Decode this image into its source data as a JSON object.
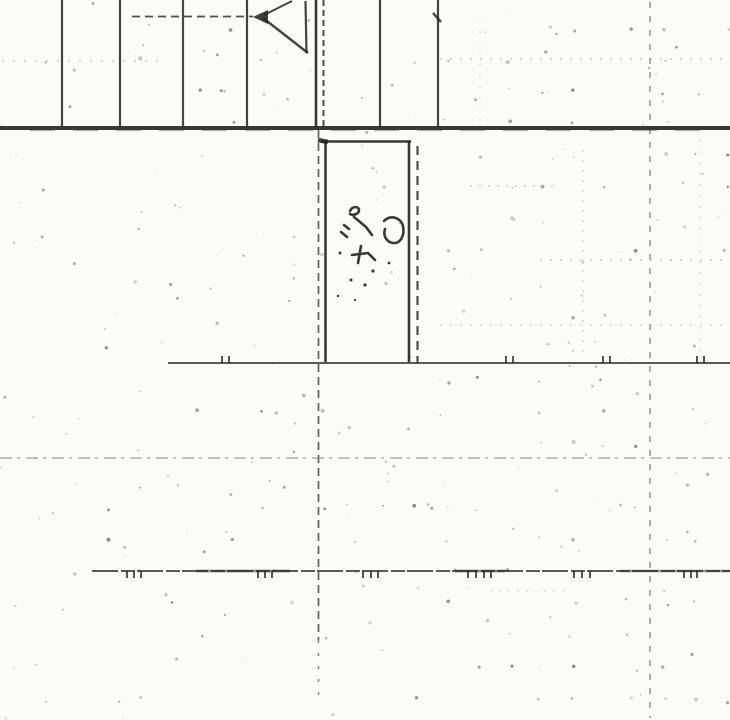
{
  "document": {
    "kind_label": "scanned architectural plan detail",
    "annotation": {
      "text": "30"
    }
  },
  "colors": {
    "paper": "#fbfbf8",
    "ink": "#26241f",
    "ink_light": "#8a887f",
    "noise": "#4a483f"
  },
  "drawing": {
    "width": 730,
    "height": 720,
    "lines": [
      {
        "name": "grid-vertical-1",
        "x1": 62,
        "y1": 0,
        "x2": 62,
        "y2": 126,
        "w": 2.2,
        "o": 0.85
      },
      {
        "name": "grid-vertical-2",
        "x1": 120,
        "y1": 0,
        "x2": 120,
        "y2": 126,
        "w": 2.2,
        "o": 0.85
      },
      {
        "name": "grid-vertical-3",
        "x1": 183,
        "y1": 0,
        "x2": 183,
        "y2": 126,
        "w": 2.2,
        "o": 0.82
      },
      {
        "name": "grid-vertical-4",
        "x1": 247,
        "y1": 0,
        "x2": 247,
        "y2": 126,
        "w": 2.2,
        "o": 0.85
      },
      {
        "name": "wall-jamb-solid",
        "x1": 316,
        "y1": 0,
        "x2": 316,
        "y2": 127,
        "w": 2.6,
        "o": 0.9
      },
      {
        "name": "wall-jamb-dashed",
        "x1": 323.5,
        "y1": 0,
        "x2": 323.5,
        "y2": 127,
        "w": 2.0,
        "o": 0.8,
        "dash": "6 4"
      },
      {
        "name": "grid-vertical-5",
        "x1": 380,
        "y1": 0,
        "x2": 380,
        "y2": 127,
        "w": 2.2,
        "o": 0.85
      },
      {
        "name": "grid-vertical-6",
        "x1": 438,
        "y1": 0,
        "x2": 438,
        "y2": 127,
        "w": 2.2,
        "o": 0.85
      },
      {
        "name": "grid-v6-top-tick",
        "x1": 433,
        "y1": 13,
        "x2": 441,
        "y2": 22,
        "w": 2.6,
        "o": 0.8
      },
      {
        "name": "floor-line-main",
        "x1": 0,
        "y1": 128,
        "x2": 730,
        "y2": 128,
        "w": 4.0,
        "o": 0.9
      },
      {
        "name": "floor-line-texture",
        "x1": 30,
        "y1": 130.5,
        "x2": 710,
        "y2": 130.5,
        "w": 1.2,
        "o": 0.35,
        "dash": "25 18"
      },
      {
        "name": "arrow-leader-dashed",
        "x1": 132,
        "y1": 16.5,
        "x2": 253,
        "y2": 16.5,
        "w": 1.8,
        "o": 0.8,
        "dash": "8 5"
      },
      {
        "name": "arrow-upper-diagonal",
        "x1": 264,
        "y1": 15,
        "x2": 292,
        "y2": 1,
        "w": 2.0,
        "o": 0.85
      },
      {
        "name": "arrow-lower-diagonal",
        "x1": 263,
        "y1": 18,
        "x2": 308,
        "y2": 53,
        "w": 2.4,
        "o": 0.85
      },
      {
        "name": "arrow-right-vertical",
        "x1": 305.5,
        "y1": 1,
        "x2": 306.5,
        "y2": 53,
        "w": 2.2,
        "o": 0.85
      },
      {
        "name": "door-left-edge",
        "x1": 325.5,
        "y1": 140,
        "x2": 325.5,
        "y2": 362,
        "w": 2.6,
        "o": 0.9
      },
      {
        "name": "door-top-edge",
        "x1": 321,
        "y1": 141.5,
        "x2": 411,
        "y2": 141.5,
        "w": 2.6,
        "o": 0.9
      },
      {
        "name": "door-corner-blob",
        "x1": 318,
        "y1": 140,
        "x2": 328,
        "y2": 142,
        "w": 4.5,
        "o": 0.85
      },
      {
        "name": "door-right-edge",
        "x1": 409,
        "y1": 141,
        "x2": 409,
        "y2": 362,
        "w": 2.6,
        "o": 0.9
      },
      {
        "name": "door-right-dashed",
        "x1": 417.5,
        "y1": 146,
        "x2": 417.5,
        "y2": 363,
        "w": 2.2,
        "o": 0.8,
        "dash": "9 6"
      },
      {
        "name": "center-axis-dashed",
        "x1": 318.5,
        "y1": 130,
        "x2": 318.5,
        "y2": 640,
        "w": 1.7,
        "o": 0.72,
        "dash": "8 5"
      },
      {
        "name": "center-axis-dotted-tail",
        "x1": 318.5,
        "y1": 640,
        "x2": 318.5,
        "y2": 698,
        "w": 1.5,
        "o": 0.55,
        "dash": "3 10"
      },
      {
        "name": "right-axis-dashed",
        "x1": 650,
        "y1": 2,
        "x2": 650,
        "y2": 718,
        "w": 1.4,
        "o": 0.5,
        "dash": "6 8"
      },
      {
        "name": "level-line-upper",
        "x1": 168,
        "y1": 363,
        "x2": 730,
        "y2": 363,
        "w": 1.7,
        "o": 0.85
      },
      {
        "name": "level-line-middle-faint",
        "x1": 0,
        "y1": 458,
        "x2": 730,
        "y2": 458,
        "w": 1.3,
        "o": 0.8,
        "dash": "12 5 3 6",
        "light": true
      },
      {
        "name": "level-line-lower",
        "x1": 92,
        "y1": 571,
        "x2": 730,
        "y2": 571,
        "w": 1.7,
        "o": 0.85,
        "dash": "26 3 14 2"
      },
      {
        "name": "lower-line-thick-1",
        "x1": 196,
        "y1": 571,
        "x2": 290,
        "y2": 571,
        "w": 2.8,
        "o": 0.5
      },
      {
        "name": "lower-line-thick-2",
        "x1": 455,
        "y1": 571,
        "x2": 505,
        "y2": 571,
        "w": 2.8,
        "o": 0.5
      },
      {
        "name": "lower-line-thick-3",
        "x1": 620,
        "y1": 571,
        "x2": 730,
        "y2": 571,
        "w": 2.4,
        "o": 0.45
      },
      {
        "name": "texture-row-top-left",
        "x1": 2,
        "y1": 61,
        "x2": 160,
        "y2": 61,
        "w": 1.2,
        "o": 0.5,
        "dash": "2 9",
        "light": true
      },
      {
        "name": "texture-row-top-right",
        "x1": 440,
        "y1": 59,
        "x2": 728,
        "y2": 59,
        "w": 1.2,
        "o": 0.5,
        "dash": "2 8",
        "light": true
      },
      {
        "name": "texture-row-mid-1",
        "x1": 470,
        "y1": 186,
        "x2": 560,
        "y2": 186,
        "w": 1.2,
        "o": 0.45,
        "dash": "2 7",
        "light": true
      },
      {
        "name": "texture-row-mid-2",
        "x1": 540,
        "y1": 260,
        "x2": 730,
        "y2": 260,
        "w": 1.2,
        "o": 0.45,
        "dash": "2 8",
        "light": true
      },
      {
        "name": "texture-row-mid-3",
        "x1": 440,
        "y1": 325,
        "x2": 730,
        "y2": 325,
        "w": 1.2,
        "o": 0.4,
        "dash": "2 8",
        "light": true
      },
      {
        "name": "texture-row-low",
        "x1": 490,
        "y1": 591,
        "x2": 565,
        "y2": 591,
        "w": 1.1,
        "o": 0.4,
        "dash": "2 7",
        "light": true
      },
      {
        "name": "texture-col-1",
        "x1": 583,
        "y1": 150,
        "x2": 583,
        "y2": 360,
        "w": 1.2,
        "o": 0.4,
        "dash": "2 8",
        "light": true
      },
      {
        "name": "texture-col-2",
        "x1": 700,
        "y1": 140,
        "x2": 700,
        "y2": 360,
        "w": 1.2,
        "o": 0.35,
        "dash": "2 9",
        "light": true
      },
      {
        "name": "texture-col-3",
        "x1": 480,
        "y1": 20,
        "x2": 480,
        "y2": 125,
        "w": 1.2,
        "o": 0.35,
        "dash": "2 9",
        "light": true
      }
    ],
    "polygons": [
      {
        "name": "arrow-head",
        "points": "253,17 268,10 268,24",
        "o": 0.88
      }
    ],
    "tick_groups": [
      {
        "name": "upper-level-ticks",
        "y": 363,
        "dir": -1,
        "h": 7,
        "w": 1.8,
        "o": 0.85,
        "xs": [
          222,
          229,
          506,
          513,
          603,
          610,
          697,
          704
        ]
      },
      {
        "name": "lower-level-ticks",
        "y": 571,
        "dir": 1,
        "h": 7,
        "w": 1.8,
        "o": 0.85,
        "xs": [
          127,
          134,
          141,
          258,
          265,
          272,
          363,
          371,
          378,
          468,
          476,
          484,
          491,
          574,
          582,
          590,
          684,
          691,
          697
        ]
      }
    ],
    "scribble": {
      "stroke_w": 2.6,
      "paths": [
        "M350,211 c2,-5 9,-5 9,-1 c0,4 -6,6 -9,4",
        "M354,217 l12,10 l6,8",
        "M384,221 c7,-7 17,-3 19,5 c2,10 -3,18 -10,17 c-7,-1 -10,-8 -8,-14",
        "M344,225 l5,4",
        "M341,232 l6,5",
        "M361,246 l-3,17",
        "M352,255 l16,-2 l7,7"
      ],
      "dots": [
        [
          340,
          253,
          1.5
        ],
        [
          373,
          271,
          1.6
        ],
        [
          389,
          263,
          1.4
        ],
        [
          351,
          280,
          1.5
        ],
        [
          365,
          285,
          1.6
        ],
        [
          338,
          296,
          1.2
        ],
        [
          355,
          300,
          1.1
        ]
      ]
    },
    "noise": {
      "seed": 7,
      "grid_offset_x": 14,
      "grid_offset_y": 28,
      "grid_step_x": 31,
      "grid_step_y": 32,
      "p_left": 0.13,
      "p_right": 0.3,
      "right_threshold": 420,
      "uniform_count": 180
    }
  }
}
